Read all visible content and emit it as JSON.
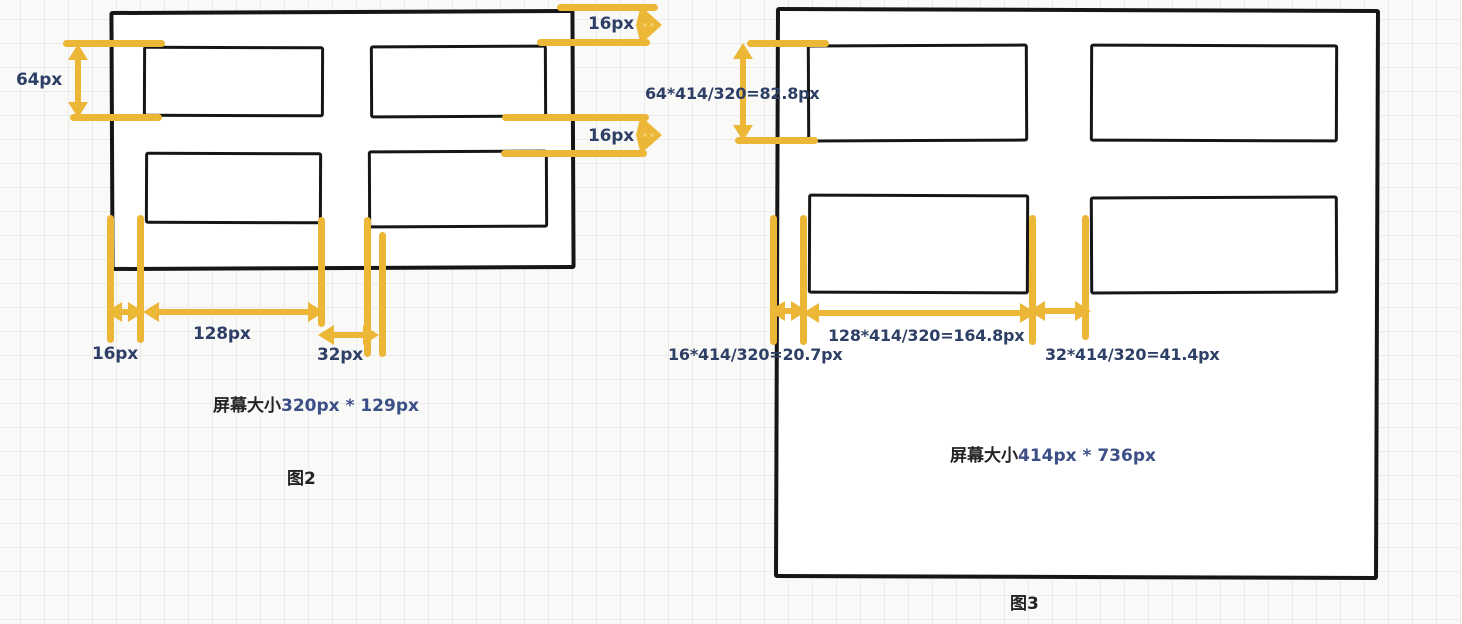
{
  "figure2": {
    "caption_prefix": "屏幕大小",
    "caption_value": "320px * 129px",
    "name": "图2",
    "dim_header_height": "64px",
    "dim_top_margin": "16px",
    "dim_row_gap": "16px",
    "dim_left_margin": "16px",
    "dim_content_width": "128px",
    "dim_column_gap": "32px"
  },
  "figure3": {
    "caption_prefix": "屏幕大小",
    "caption_value": "414px * 736px",
    "name": "图3",
    "dim_header_height": "64*414/320=82.8px",
    "dim_left_margin": "16*414/320=20.7px",
    "dim_content_width": "128*414/320=164.8px",
    "dim_column_gap": "32*414/320=41.4px"
  },
  "colors": {
    "highlight_yellow": "#ECB737",
    "stroke_ink": "#161616",
    "dimension_text": "#2E3F66"
  }
}
